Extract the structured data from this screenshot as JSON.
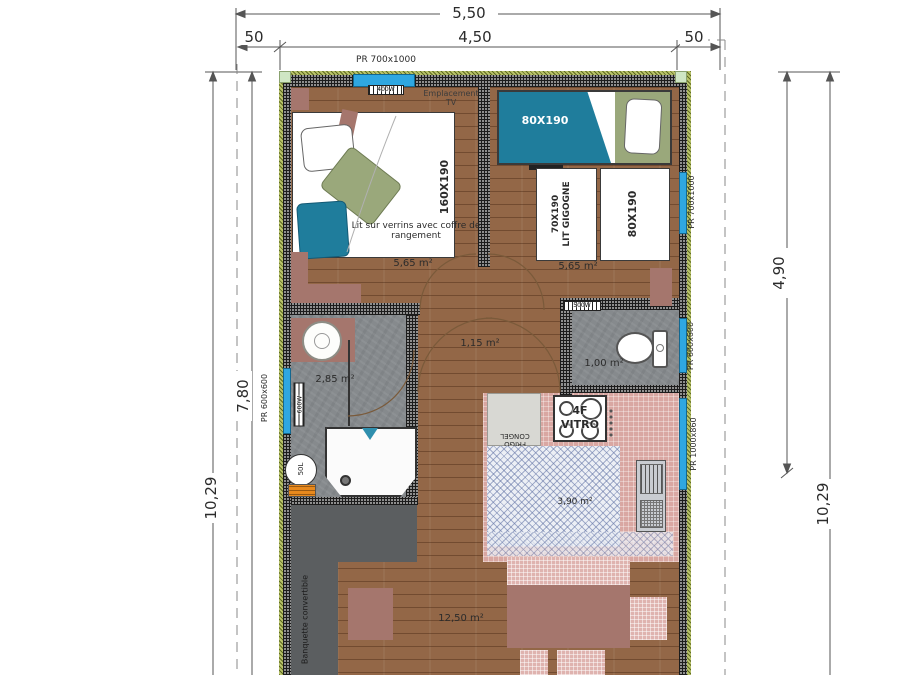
{
  "colors": {
    "window_blue": "#2fa7e1",
    "bed_teal": "#1f7d9c",
    "bed_olive": "#9aa87b",
    "furniture_mauve": "#a5766d",
    "kitchen_pink": "#d9a7a2",
    "exterior_green": "#b9c36a"
  },
  "dims": {
    "top_total": "5,50",
    "top_left": "50",
    "top_mid": "4,50",
    "top_right": "50",
    "left_inner": "7,80",
    "left_outer": "10,29",
    "right_inner": "4,90",
    "right_outer": "10,29"
  },
  "windows": {
    "top": "PR 700x1000",
    "right_bedroom": "PR 700x1000",
    "right_wc": "PR 600x600",
    "right_kitchen": "PR 1000x860",
    "left_bathroom": "PR 600x600"
  },
  "bedroom1": {
    "tv_label": "Emplacement TV",
    "radiator": "400W",
    "bed_size": "160X190",
    "bed_note": "Lit sur verrins avec coffre de rangement",
    "area": "5,65 m²"
  },
  "bedroom2": {
    "bunk_top_size": "80X190",
    "trundle_size": "70X190",
    "trundle_label": "LIT GIGOGNE",
    "single_size": "80X190",
    "area": "5,65 m²"
  },
  "hallway": {
    "area": "1,15 m²"
  },
  "bathroom": {
    "area": "2,85 m²",
    "radiator": "600W",
    "water_heater": "50L"
  },
  "wc": {
    "area": "1,00 m²",
    "radiator": "500W"
  },
  "kitchen": {
    "area": "3,90 m²",
    "fridge_label": "FRIGO CONGEL",
    "hob_line1": "4F",
    "hob_line2": "VITRO"
  },
  "living": {
    "area": "12,50 m²",
    "bench_label": "Banquette convertible"
  }
}
